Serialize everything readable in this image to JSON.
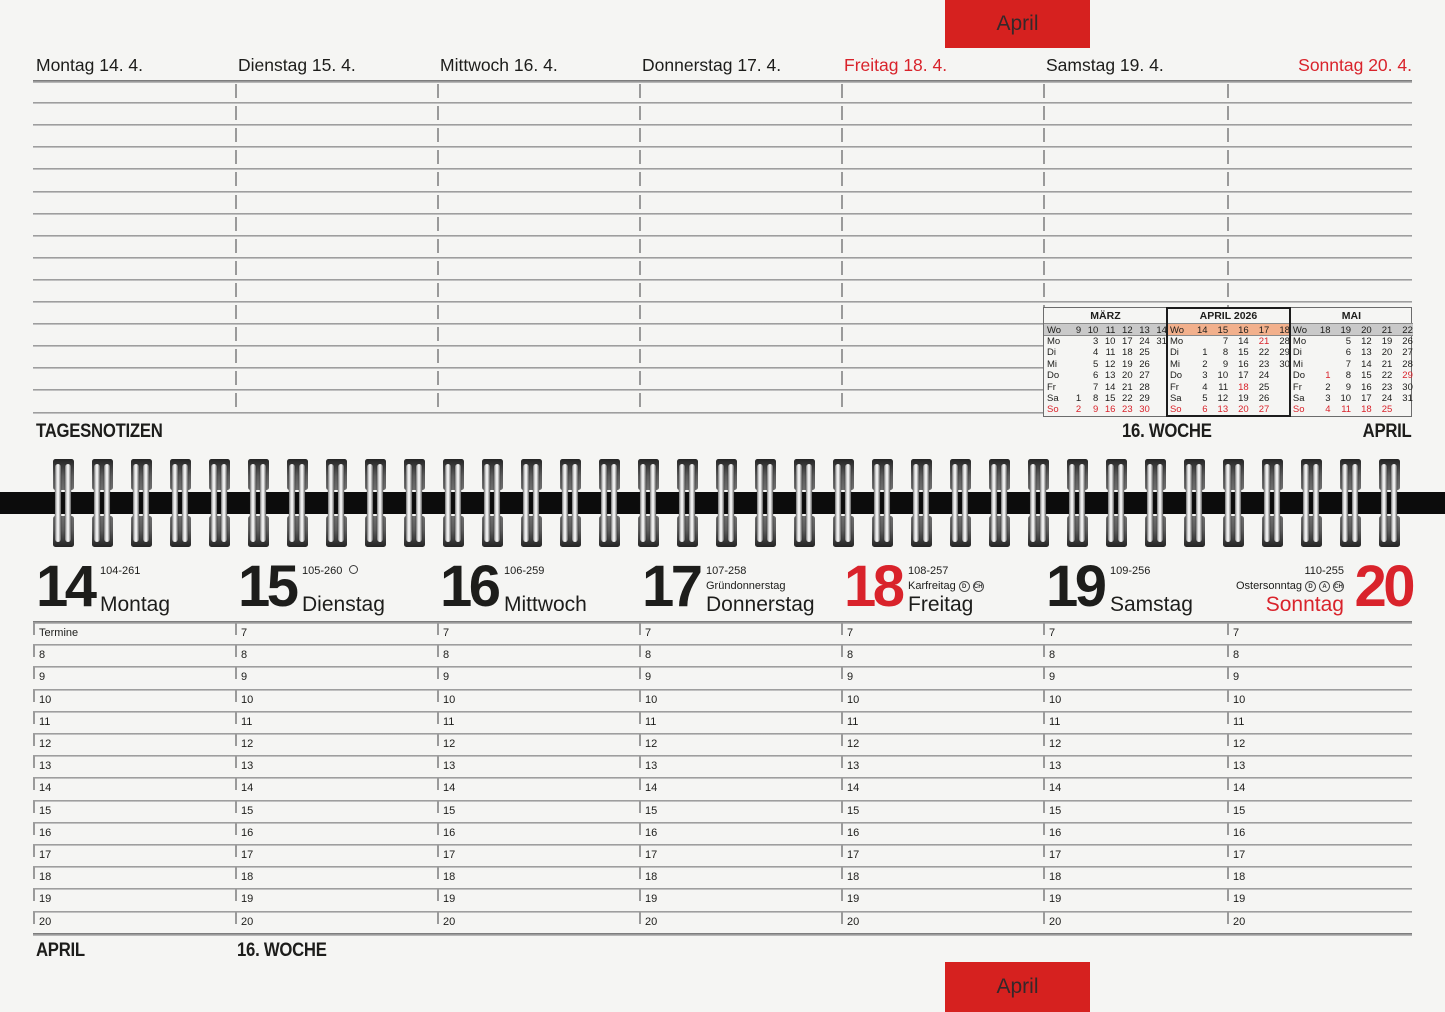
{
  "colors": {
    "paper": "#f5f5f3",
    "red": "#d9232b",
    "tab_red": "#d6211f",
    "line_gray": "#9a9a9a"
  },
  "tabs": {
    "top_label": "April",
    "bottom_label": "April"
  },
  "notes_page": {
    "day_headers": [
      {
        "label": "Montag 14. 4.",
        "red": false
      },
      {
        "label": "Dienstag 15. 4.",
        "red": false
      },
      {
        "label": "Mittwoch 16. 4.",
        "red": false
      },
      {
        "label": "Donnerstag 17. 4.",
        "red": false
      },
      {
        "label": "Freitag 18. 4.",
        "red": true
      },
      {
        "label": "Samstag 19. 4.",
        "red": false
      },
      {
        "label": "Sonntag 20. 4.",
        "red": true
      }
    ],
    "footer": {
      "left": "TAGESNOTIZEN",
      "center": "16. WOCHE",
      "right": "APRIL"
    },
    "mini_calendar": {
      "months": [
        {
          "title": "MÄRZ",
          "highlight": false,
          "wo_row": [
            "Wo",
            "9",
            "10",
            "11",
            "12",
            "13",
            "14"
          ],
          "rows": [
            {
              "d": "Mo",
              "cells": [
                "",
                "3",
                "10",
                "17",
                "24",
                "31"
              ]
            },
            {
              "d": "Di",
              "cells": [
                "",
                "4",
                "11",
                "18",
                "25",
                ""
              ]
            },
            {
              "d": "Mi",
              "cells": [
                "",
                "5",
                "12",
                "19",
                "26",
                ""
              ]
            },
            {
              "d": "Do",
              "cells": [
                "",
                "6",
                "13",
                "20",
                "27",
                ""
              ]
            },
            {
              "d": "Fr",
              "cells": [
                "",
                "7",
                "14",
                "21",
                "28",
                ""
              ]
            },
            {
              "d": "Sa",
              "cells": [
                "1",
                "8",
                "15",
                "22",
                "29",
                ""
              ]
            },
            {
              "d": "*So",
              "cells": [
                "*2",
                "*9",
                "*16",
                "*23",
                "*30",
                ""
              ]
            }
          ]
        },
        {
          "title": "APRIL 2026",
          "highlight": true,
          "wo_row": [
            "Wo",
            "14",
            "15",
            "16",
            "17",
            "18"
          ],
          "rows": [
            {
              "d": "Mo",
              "cells": [
                "",
                "7",
                "14",
                "*21",
                "28"
              ]
            },
            {
              "d": "Di",
              "cells": [
                "1",
                "8",
                "15",
                "22",
                "29"
              ]
            },
            {
              "d": "Mi",
              "cells": [
                "2",
                "9",
                "16",
                "23",
                "30"
              ]
            },
            {
              "d": "Do",
              "cells": [
                "3",
                "10",
                "17",
                "24",
                ""
              ]
            },
            {
              "d": "Fr",
              "cells": [
                "4",
                "11",
                "*18",
                "25",
                ""
              ]
            },
            {
              "d": "Sa",
              "cells": [
                "5",
                "12",
                "19",
                "26",
                ""
              ]
            },
            {
              "d": "*So",
              "cells": [
                "*6",
                "*13",
                "*20",
                "*27",
                ""
              ]
            }
          ]
        },
        {
          "title": "MAI",
          "highlight": false,
          "wo_row": [
            "Wo",
            "18",
            "19",
            "20",
            "21",
            "22"
          ],
          "rows": [
            {
              "d": "Mo",
              "cells": [
                "",
                "5",
                "12",
                "19",
                "26"
              ]
            },
            {
              "d": "Di",
              "cells": [
                "",
                "6",
                "13",
                "20",
                "27"
              ]
            },
            {
              "d": "Mi",
              "cells": [
                "",
                "7",
                "14",
                "21",
                "28"
              ]
            },
            {
              "d": "Do",
              "cells": [
                "*1",
                "8",
                "15",
                "22",
                "*29"
              ]
            },
            {
              "d": "Fr",
              "cells": [
                "2",
                "9",
                "16",
                "23",
                "30"
              ]
            },
            {
              "d": "Sa",
              "cells": [
                "3",
                "10",
                "17",
                "24",
                "31"
              ]
            },
            {
              "d": "*So",
              "cells": [
                "*4",
                "*11",
                "*18",
                "*25",
                ""
              ]
            }
          ]
        }
      ]
    }
  },
  "week_page": {
    "days": [
      {
        "num": "14",
        "code": "104-261",
        "holiday": "",
        "icons": [],
        "name": "Montag",
        "red_num": false,
        "red_name": false,
        "moon": false,
        "mirrored": false
      },
      {
        "num": "15",
        "code": "105-260",
        "holiday": "",
        "icons": [],
        "name": "Dienstag",
        "red_num": false,
        "red_name": false,
        "moon": true,
        "mirrored": false
      },
      {
        "num": "16",
        "code": "106-259",
        "holiday": "",
        "icons": [],
        "name": "Mittwoch",
        "red_num": false,
        "red_name": false,
        "moon": false,
        "mirrored": false
      },
      {
        "num": "17",
        "code": "107-258",
        "holiday": "Gründonnerstag",
        "icons": [],
        "name": "Donnerstag",
        "red_num": false,
        "red_name": false,
        "moon": false,
        "mirrored": false
      },
      {
        "num": "18",
        "code": "108-257",
        "holiday": "Karfreitag",
        "icons": [
          "D",
          "CH"
        ],
        "name": "Freitag",
        "red_num": true,
        "red_name": false,
        "moon": false,
        "mirrored": false
      },
      {
        "num": "19",
        "code": "109-256",
        "holiday": "",
        "icons": [],
        "name": "Samstag",
        "red_num": false,
        "red_name": false,
        "moon": false,
        "mirrored": false
      },
      {
        "num": "20",
        "code": "110-255",
        "holiday": "Ostersonntag",
        "icons": [
          "D",
          "A",
          "CH"
        ],
        "name": "Sonntag",
        "red_num": true,
        "red_name": true,
        "moon": false,
        "mirrored": true
      }
    ],
    "first_cell_label": "Termine",
    "hours": [
      "7",
      "8",
      "9",
      "10",
      "11",
      "12",
      "13",
      "14",
      "15",
      "16",
      "17",
      "18",
      "19",
      "20"
    ],
    "footer": {
      "left": "APRIL",
      "center": "16. WOCHE"
    }
  }
}
